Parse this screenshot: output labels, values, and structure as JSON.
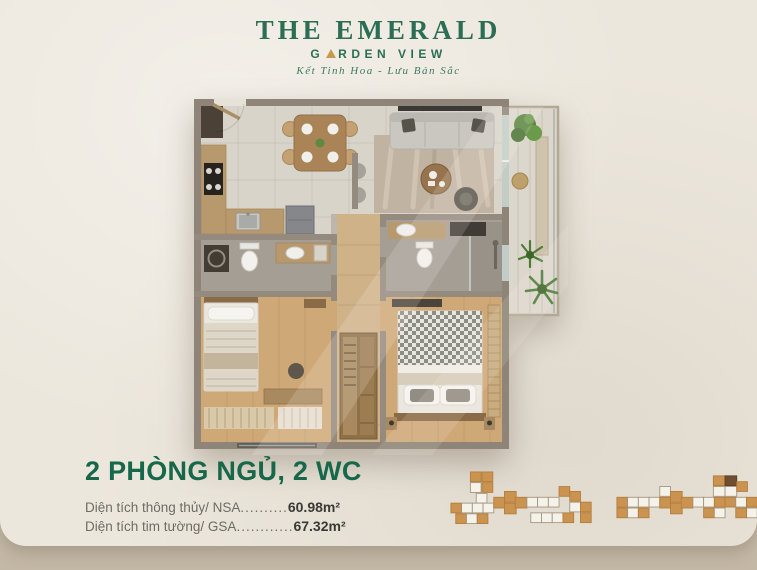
{
  "brand": {
    "title": "THE EMERALD",
    "subtitle_before_triangle": "G",
    "subtitle_after_triangle": "RDEN VIEW",
    "tagline": "Kết Tinh Hoa - Lưu Bản Sắc"
  },
  "unit": {
    "title": "2 PHÒNG NGỦ, 2 WC",
    "areas": [
      {
        "label": "Diện tích thông thủy/ NSA",
        "dots": "..........",
        "value": "60.98m²"
      },
      {
        "label": "Diện tích tim tường/ GSA",
        "dots": "............",
        "value": "67.32m²"
      }
    ]
  },
  "colors": {
    "brand_green": "#2c6e55",
    "heading_green": "#17684b",
    "gold_triangle": "#c59a4d",
    "card_background": "#ece7dd",
    "page_background": "#c9bdae",
    "keyplan_unit_orange": "#cb9350",
    "keyplan_unit_highlight": "#6f4f2f"
  }
}
